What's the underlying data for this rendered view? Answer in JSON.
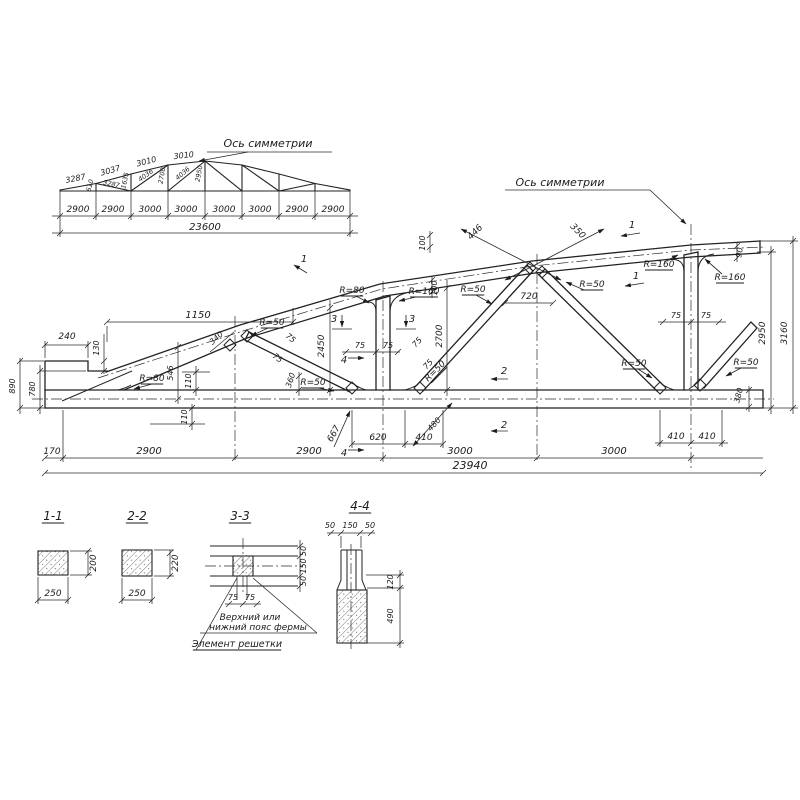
{
  "sheet": {
    "background": "#ffffff",
    "ink": "#1b1b1b",
    "kind": "reinforced concrete truss working drawing"
  },
  "schematic": {
    "axis_label": "Ось симметрии",
    "top_chord_dims": [
      "3287",
      "3037",
      "3010",
      "3010"
    ],
    "web_dims": [
      "610",
      "3287",
      "1635",
      "4036",
      "2700",
      "4036",
      "2950"
    ],
    "panel_dims": [
      "2900",
      "2900",
      "3000",
      "3000",
      "3000",
      "3000",
      "2900",
      "2900"
    ],
    "total_dim": "23600",
    "labels": [
      {
        "t": "Ось симметрии",
        "x": 268,
        "y": 147,
        "fs": 11,
        "n": "axis-of-symmetry-label"
      },
      {
        "t": "3287",
        "x": 76,
        "y": 181,
        "r": -11,
        "fs": 8
      },
      {
        "t": "3037",
        "x": 111,
        "y": 173,
        "r": -15,
        "fs": 8
      },
      {
        "t": "3010",
        "x": 147,
        "y": 164,
        "r": -14,
        "fs": 8
      },
      {
        "t": "3010",
        "x": 184,
        "y": 158,
        "r": -6,
        "fs": 8
      },
      {
        "t": "610",
        "x": 92,
        "y": 186,
        "r": -76,
        "fs": 6.5
      },
      {
        "t": "3287",
        "x": 111,
        "y": 186,
        "r": 12,
        "fs": 6.5
      },
      {
        "t": "1635",
        "x": 127,
        "y": 181,
        "r": -78,
        "fs": 6.5
      },
      {
        "t": "4036",
        "x": 147,
        "y": 177,
        "r": -36,
        "fs": 6.5
      },
      {
        "t": "2700",
        "x": 164,
        "y": 176,
        "r": -80,
        "fs": 6.5
      },
      {
        "t": "4036",
        "x": 184,
        "y": 175,
        "r": -40,
        "fs": 6.5
      },
      {
        "t": "2950",
        "x": 201,
        "y": 174,
        "r": -80,
        "fs": 6.5
      },
      {
        "t": "2900",
        "x": 78,
        "y": 212,
        "fs": 9
      },
      {
        "t": "2900",
        "x": 113,
        "y": 212,
        "fs": 9
      },
      {
        "t": "3000",
        "x": 150,
        "y": 212,
        "fs": 9
      },
      {
        "t": "3000",
        "x": 186,
        "y": 212,
        "fs": 9
      },
      {
        "t": "3000",
        "x": 224,
        "y": 212,
        "fs": 9
      },
      {
        "t": "3000",
        "x": 260,
        "y": 212,
        "fs": 9
      },
      {
        "t": "2900",
        "x": 297,
        "y": 212,
        "fs": 9
      },
      {
        "t": "2900",
        "x": 333,
        "y": 212,
        "fs": 9
      },
      {
        "t": "23600",
        "x": 205,
        "y": 230,
        "fs": 10
      }
    ]
  },
  "main": {
    "axis_label": "Ось симметрии",
    "overall_dims": {
      "length": "23940",
      "height_right": "3160",
      "height_mid": "2950",
      "end_height": "890"
    },
    "labels": [
      {
        "t": "Ось симметрии",
        "x": 560,
        "y": 186,
        "fs": 11,
        "n": "axis-of-symmetry-label"
      },
      {
        "t": "1150",
        "x": 198,
        "y": 318
      },
      {
        "t": "240",
        "x": 67,
        "y": 339,
        "fs": 9
      },
      {
        "t": "130",
        "x": 99,
        "y": 348,
        "r": -90,
        "fs": 8
      },
      {
        "t": "890",
        "x": 15,
        "y": 386,
        "r": -90,
        "fs": 8
      },
      {
        "t": "780",
        "x": 35,
        "y": 389,
        "r": -90,
        "fs": 8
      },
      {
        "t": "546",
        "x": 173,
        "y": 373,
        "r": -90,
        "fs": 8
      },
      {
        "t": "110",
        "x": 191,
        "y": 381,
        "r": -90,
        "fs": 8
      },
      {
        "t": "110",
        "x": 187,
        "y": 417,
        "r": -90,
        "fs": 8
      },
      {
        "t": "R=80",
        "x": 152,
        "y": 381,
        "fs": 9,
        "u": 1
      },
      {
        "t": "340",
        "x": 218,
        "y": 340,
        "r": -42,
        "fs": 8
      },
      {
        "t": "R=50",
        "x": 272,
        "y": 325,
        "fs": 9,
        "u": 1
      },
      {
        "t": "75",
        "x": 289,
        "y": 340,
        "r": 38,
        "fs": 8
      },
      {
        "t": "75",
        "x": 276,
        "y": 360,
        "r": 38,
        "fs": 8
      },
      {
        "t": "R=50",
        "x": 313,
        "y": 385,
        "fs": 9,
        "u": 1
      },
      {
        "t": "360",
        "x": 293,
        "y": 381,
        "r": -72,
        "fs": 8
      },
      {
        "t": "2450",
        "x": 324,
        "y": 346,
        "r": -90,
        "fs": 9
      },
      {
        "t": "3",
        "x": 334,
        "y": 322,
        "fs": 10
      },
      {
        "t": "3",
        "x": 412,
        "y": 322,
        "fs": 10
      },
      {
        "t": "75",
        "x": 360,
        "y": 348,
        "fs": 8
      },
      {
        "t": "75",
        "x": 388,
        "y": 348,
        "fs": 8
      },
      {
        "t": "4",
        "x": 344,
        "y": 363,
        "fs": 10
      },
      {
        "t": "4",
        "x": 344,
        "y": 456,
        "fs": 10
      },
      {
        "t": "R=80",
        "x": 352,
        "y": 293,
        "fs": 9,
        "u": 1
      },
      {
        "t": "R=160",
        "x": 424,
        "y": 294,
        "fs": 9,
        "u": 1
      },
      {
        "t": "100",
        "x": 437,
        "y": 288,
        "r": -90,
        "fs": 8
      },
      {
        "t": "100",
        "x": 425,
        "y": 243,
        "r": -90,
        "fs": 8
      },
      {
        "t": "2700",
        "x": 442,
        "y": 336,
        "r": -90,
        "fs": 9
      },
      {
        "t": "75",
        "x": 419,
        "y": 344,
        "r": -47,
        "fs": 8
      },
      {
        "t": "75",
        "x": 430,
        "y": 366,
        "r": -47,
        "fs": 8
      },
      {
        "t": "R=50",
        "x": 437,
        "y": 373,
        "r": -45,
        "fs": 9,
        "u": 1
      },
      {
        "t": "R=50",
        "x": 473,
        "y": 292,
        "fs": 9,
        "u": 1
      },
      {
        "t": "720",
        "x": 529,
        "y": 299,
        "fs": 9
      },
      {
        "t": "446",
        "x": 477,
        "y": 234,
        "r": -45,
        "fs": 9
      },
      {
        "t": "350",
        "x": 576,
        "y": 233,
        "r": 45,
        "fs": 9
      },
      {
        "t": "R=50",
        "x": 592,
        "y": 287,
        "fs": 9,
        "u": 1
      },
      {
        "t": "2",
        "x": 504,
        "y": 374,
        "fs": 10
      },
      {
        "t": "2",
        "x": 504,
        "y": 428,
        "fs": 10
      },
      {
        "t": "1",
        "x": 304,
        "y": 262,
        "fs": 10
      },
      {
        "t": "1",
        "x": 632,
        "y": 228,
        "fs": 10
      },
      {
        "t": "1",
        "x": 636,
        "y": 279,
        "fs": 10
      },
      {
        "t": "R=160",
        "x": 659,
        "y": 267,
        "fs": 9,
        "u": 1
      },
      {
        "t": "R=160",
        "x": 730,
        "y": 280,
        "fs": 9,
        "u": 1
      },
      {
        "t": "R=50",
        "x": 634,
        "y": 366,
        "fs": 9,
        "u": 1
      },
      {
        "t": "R=50",
        "x": 746,
        "y": 365,
        "fs": 9,
        "u": 1
      },
      {
        "t": "75",
        "x": 676,
        "y": 318,
        "fs": 8
      },
      {
        "t": "75",
        "x": 706,
        "y": 318,
        "fs": 8
      },
      {
        "t": "90",
        "x": 742,
        "y": 253,
        "r": -80,
        "fs": 8
      },
      {
        "t": "2950",
        "x": 765,
        "y": 333,
        "r": -90,
        "fs": 9
      },
      {
        "t": "3160",
        "x": 787,
        "y": 333,
        "r": -90,
        "fs": 9
      },
      {
        "t": "380",
        "x": 741,
        "y": 396,
        "r": -75,
        "fs": 8
      },
      {
        "t": "667",
        "x": 336,
        "y": 435,
        "r": -60,
        "fs": 9
      },
      {
        "t": "620",
        "x": 378,
        "y": 440,
        "fs": 9
      },
      {
        "t": "410",
        "x": 424,
        "y": 440,
        "fs": 9
      },
      {
        "t": "480",
        "x": 436,
        "y": 426,
        "r": -47,
        "fs": 8
      },
      {
        "t": "410",
        "x": 676,
        "y": 439,
        "fs": 9
      },
      {
        "t": "410",
        "x": 707,
        "y": 439,
        "fs": 9
      },
      {
        "t": "170",
        "x": 52,
        "y": 454,
        "fs": 9
      },
      {
        "t": "2900",
        "x": 149,
        "y": 454
      },
      {
        "t": "2900",
        "x": 309,
        "y": 454
      },
      {
        "t": "3000",
        "x": 460,
        "y": 454
      },
      {
        "t": "3000",
        "x": 614,
        "y": 454
      },
      {
        "t": "23940",
        "x": 470,
        "y": 469,
        "fs": 11
      }
    ]
  },
  "sections": {
    "titles": [
      "1-1",
      "2-2",
      "3-3",
      "4-4"
    ],
    "notes": [
      "Верхний или",
      "нижний пояс фермы",
      "Элемент решетки"
    ],
    "labels": [
      {
        "t": "1-1",
        "x": 53,
        "y": 520,
        "fs": 12,
        "u": 1,
        "n": "section-title-1-1"
      },
      {
        "t": "250",
        "x": 53,
        "y": 596,
        "fs": 9
      },
      {
        "t": "200",
        "x": 96,
        "y": 563,
        "r": -90,
        "fs": 9
      },
      {
        "t": "2-2",
        "x": 137,
        "y": 520,
        "fs": 12,
        "u": 1,
        "n": "section-title-2-2"
      },
      {
        "t": "250",
        "x": 137,
        "y": 596,
        "fs": 9
      },
      {
        "t": "220",
        "x": 178,
        "y": 563,
        "r": -90,
        "fs": 9
      },
      {
        "t": "3-3",
        "x": 240,
        "y": 520,
        "fs": 12,
        "u": 1,
        "n": "section-title-3-3"
      },
      {
        "t": "50",
        "x": 306,
        "y": 551,
        "r": -90,
        "fs": 8
      },
      {
        "t": "150",
        "x": 306,
        "y": 566,
        "r": -90,
        "fs": 8
      },
      {
        "t": "50",
        "x": 306,
        "y": 581,
        "r": -90,
        "fs": 8
      },
      {
        "t": "75",
        "x": 233,
        "y": 600,
        "fs": 8
      },
      {
        "t": "75",
        "x": 250,
        "y": 600,
        "fs": 8
      },
      {
        "t": "Верхний или",
        "x": 250,
        "y": 620,
        "fs": 9,
        "n": "note-chord-line1"
      },
      {
        "t": "нижний пояс фермы",
        "x": 258,
        "y": 630,
        "fs": 9,
        "n": "note-chord-line2"
      },
      {
        "t": "Элемент решетки",
        "x": 237,
        "y": 647,
        "fs": 9.5,
        "u": 1,
        "n": "note-lattice-element"
      },
      {
        "t": "4-4",
        "x": 360,
        "y": 510,
        "fs": 12,
        "u": 1,
        "n": "section-title-4-4"
      },
      {
        "t": "50",
        "x": 330,
        "y": 528,
        "fs": 8
      },
      {
        "t": "150",
        "x": 350,
        "y": 528,
        "fs": 8
      },
      {
        "t": "50",
        "x": 370,
        "y": 528,
        "fs": 8
      },
      {
        "t": "120",
        "x": 393,
        "y": 582,
        "r": -90,
        "fs": 8
      },
      {
        "t": "490",
        "x": 393,
        "y": 616,
        "r": -90,
        "fs": 8
      }
    ]
  }
}
